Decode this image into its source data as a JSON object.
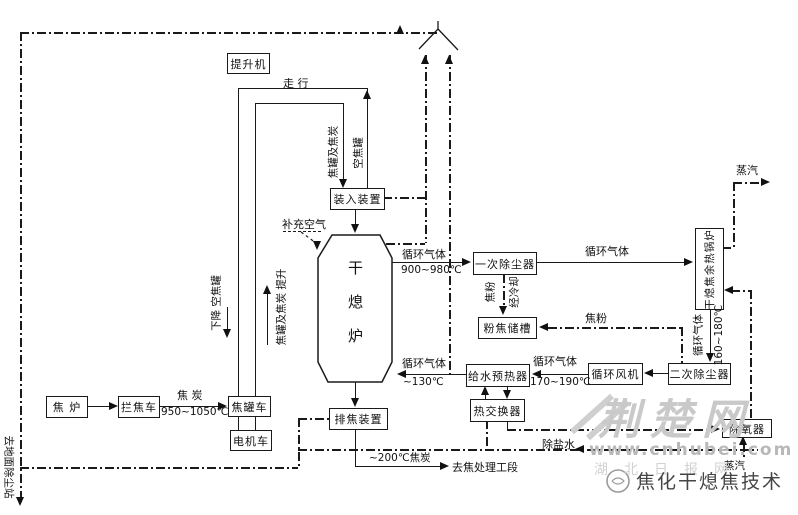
{
  "boxes": {
    "hoist": "提升机",
    "charging_device": "装入装置",
    "furnace": "干熄炉",
    "primary_dust_collector": "一次除尘器",
    "coke_powder_tank": "粉焦储槽",
    "feedwater_preheater": "给水预热器",
    "circulating_fan": "循环风机",
    "secondary_dust_collector": "二次除尘器",
    "heat_exchanger": "热交换器",
    "coke_discharge_device": "排焦装置",
    "coke_oven": "焦 炉",
    "coke_guide_car": "拦焦车",
    "coke_tank_car": "焦罐车",
    "electric_locomotive": "电机车",
    "waste_heat_boiler": "干熄焦余热锅炉",
    "deaerator": "除氧器"
  },
  "labels": {
    "travel": "走 行",
    "full_tank": "焦罐及焦炭",
    "empty_tank": "空焦罐",
    "descend_empty_tank": "下降  空焦罐",
    "lift_full_tank": "焦罐及焦炭  提升",
    "supplement_air": "补充空气",
    "circulating_gas": "循环气体",
    "temp_900_980": "900~980℃",
    "temp_130": "~130℃",
    "temp_170_190": "170~190℃",
    "temp_160_180": "160~180℃",
    "temp_950_1050": "950~1050℃",
    "coke": "焦 炭",
    "coke_powder": "焦粉",
    "after_cooling": "经冷却",
    "steam": "蒸汽",
    "desalted_water": "除盐水",
    "coke_200": "~200℃焦炭",
    "to_coke_handling": "去焦处理工段",
    "to_ground_dust_station": "去地面除尘站"
  },
  "watermark": {
    "logo": "荆楚网",
    "site": "www.cnhubei.com",
    "paper": "湖北日报网",
    "caption": "焦化干熄焦技术"
  }
}
